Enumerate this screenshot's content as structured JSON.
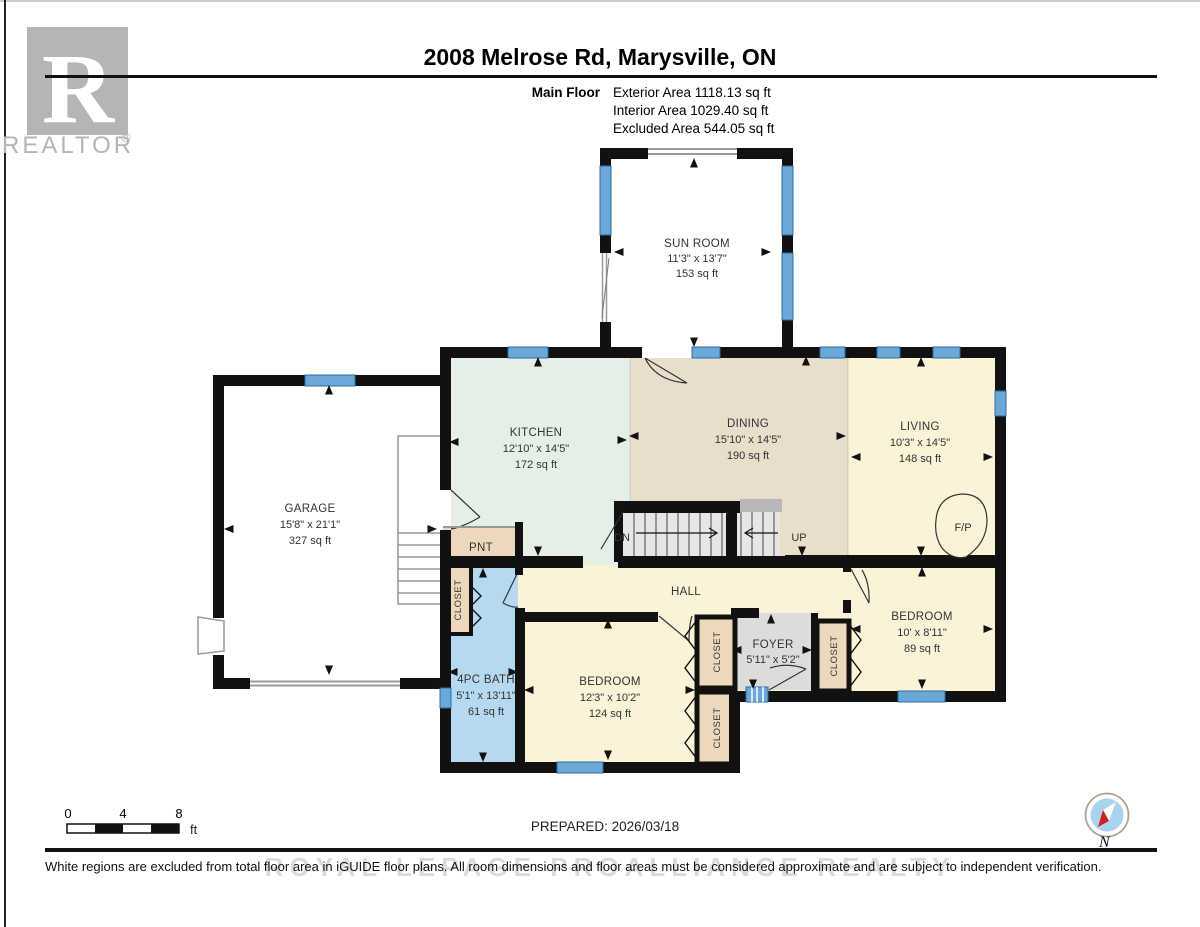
{
  "header": {
    "title": "2008 Melrose Rd, Marysville, ON",
    "floor_label": "Main Floor",
    "stats": [
      "Exterior Area 1118.13 sq ft",
      "Interior Area 1029.40 sq ft",
      "Excluded Area 544.05 sq ft"
    ]
  },
  "logo": {
    "letter": "R",
    "brand": "REALTOR",
    "registered": "®"
  },
  "rooms": {
    "sunroom": {
      "name": "SUN ROOM",
      "dims": "11'3\" x 13'7\"",
      "area": "153 sq ft"
    },
    "kitchen": {
      "name": "KITCHEN",
      "dims": "12'10\" x 14'5\"",
      "area": "172 sq ft"
    },
    "dining": {
      "name": "DINING",
      "dims": "15'10\" x 14'5\"",
      "area": "190 sq ft"
    },
    "living": {
      "name": "LIVING",
      "dims": "10'3\" x 14'5\"",
      "area": "148 sq ft"
    },
    "garage": {
      "name": "GARAGE",
      "dims": "15'8\" x 21'1\"",
      "area": "327 sq ft"
    },
    "bath": {
      "name": "4PC BATH",
      "dims": "5'1\" x 13'11\"",
      "area": "61 sq ft"
    },
    "bedroom1": {
      "name": "BEDROOM",
      "dims": "12'3\" x 10'2\"",
      "area": "124 sq ft"
    },
    "bedroom2": {
      "name": "BEDROOM",
      "dims": "10' x 8'11\"",
      "area": "89 sq ft"
    },
    "foyer": {
      "name": "FOYER",
      "dims": "5'11\" x 5'2\""
    },
    "hall": {
      "name": "HALL"
    },
    "pantry": {
      "name": "PNT"
    }
  },
  "labels": {
    "closet": "CLOSET",
    "down": "DN",
    "up": "UP",
    "fireplace": "F/P"
  },
  "scale_bar": {
    "tick0": "0",
    "tick4": "4",
    "tick8": "8",
    "unit": "ft"
  },
  "compass": {
    "north": "N"
  },
  "footer": {
    "prepared": "PREPARED: 2026/03/18",
    "disclaimer": "White regions are excluded from total floor area in iGUIDE floor plans. All room dimensions and floor areas must be considered approximate and are subject to independent verification.",
    "watermark": "ROYAL LEPAGE PROALLIANCE REALTY"
  },
  "colors": {
    "wall": "#111111",
    "window": "#69a8d8",
    "window_edge": "#2e6da4",
    "kitchen": "#e4efe6",
    "dining": "#e8decb",
    "cream": "#fbf3d8",
    "bath": "#b5d9f0",
    "closet": "#ecd9bd",
    "foyer": "#dcdcdc",
    "stairs": "#e6e6e6",
    "sunroom": "#ffffff",
    "garage": "#ffffff",
    "compass_blue": "#a9d2ef",
    "compass_red": "#cc2027",
    "logo_gray": "#b5b5b5"
  }
}
